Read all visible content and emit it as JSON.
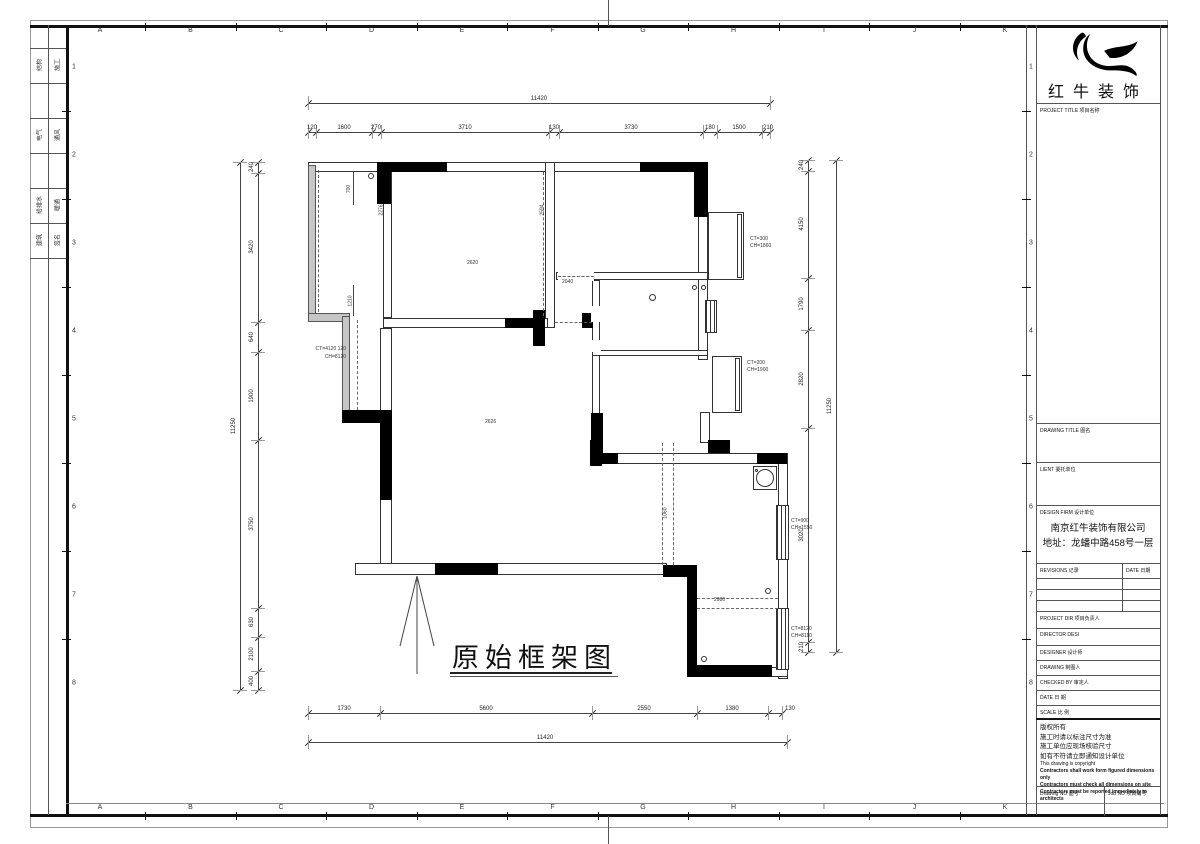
{
  "sheet": {
    "grid_letters": [
      "A",
      "B",
      "C",
      "D",
      "E",
      "F",
      "G",
      "H",
      "I",
      "J",
      "K"
    ],
    "grid_numbers": [
      "1",
      "2",
      "3",
      "4",
      "5",
      "6",
      "7",
      "8"
    ],
    "signoff": [
      [
        "结构",
        "施工"
      ],
      [
        "电气",
        "通风"
      ],
      [
        "给排水",
        "暖通"
      ],
      [
        "建筑",
        "签名"
      ]
    ]
  },
  "plan": {
    "caption": "原始框架图",
    "dims": {
      "top_total": "11420",
      "top_chain": [
        "120",
        "1600",
        "270",
        "3710",
        "130",
        "3730",
        "180",
        "1500",
        "210"
      ],
      "bottom_chain": [
        "1730",
        "5600",
        "2550",
        "1380",
        "130"
      ],
      "bottom_total": "11420",
      "left_chain": [
        "240",
        "3420",
        "640",
        "1900",
        "3750",
        "630",
        "2100",
        "400"
      ],
      "left_total": "11250",
      "right_chain": [
        "240",
        "4150",
        "1790",
        "2820",
        "3020",
        "210"
      ],
      "right_total": "11250"
    },
    "inner_dims": {
      "d700": "700",
      "d1210": "1210",
      "d2276": "2276",
      "d2594": "2594",
      "d2040": "2040",
      "d1060": "1060",
      "d2980": "2980"
    },
    "rooms": {
      "bedroom": "2620",
      "living": "2626"
    },
    "windows": {
      "w1": [
        "CT=300",
        "CH=1860"
      ],
      "w2": [
        "CT=200",
        "CH=1900"
      ],
      "w3": [
        "CT=900",
        "CH=1550"
      ],
      "w4": [
        "CT=8120",
        "CH=8110"
      ],
      "w5": [
        "CT=4120 120",
        "CH=8120"
      ]
    }
  },
  "titleblock": {
    "logo_text": "红牛装饰",
    "project_title_label": "PROJECT TITLE 项目名称",
    "drawing_title_label": "DRAWING TITLE 图名",
    "client_label": "LIENT 委托单位",
    "design_firm_label": "DESIGN FIRM 设计单位",
    "firm_name": "南京红牛装饰有限公司",
    "firm_address": "地址：龙蟠中路458号一层",
    "revisions_label": "REVISIONS 记录",
    "date_col_label": "DATE 日期",
    "project_dir_label": "PROJECT DIR 项目负责人",
    "director_label": "DIRECTOR DESI",
    "designer_label": "DESIGNER 设计师",
    "drawing_label": "DRAWING 制图人",
    "checked_label": "CHECKED BY 审定人",
    "date_label": "DATE 日 期",
    "scale_label": "SCALE 比 例",
    "notes": [
      "版权所有",
      "施工时请以标注尺寸为准",
      "施工单位应现场核验尺寸",
      "如有不符请立即通知设计单位",
      "This drawing is copyright",
      "Contractors shall work form figured dimensions only",
      "Contractors must check all dimensions on site",
      "Contractors must be reported immediately to architects"
    ],
    "drawing_no_label": "Drawing NO 图号",
    "job_no_label": "Job NO 项目编号"
  }
}
